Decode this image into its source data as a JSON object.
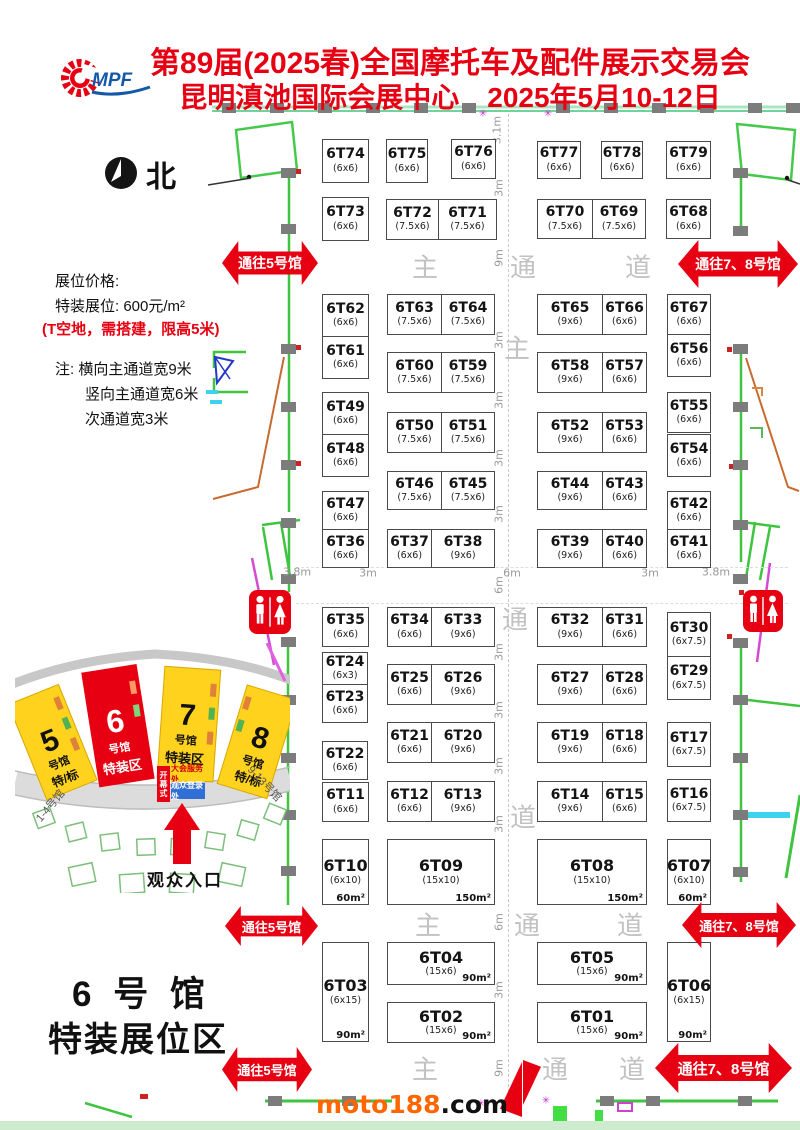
{
  "header": {
    "logo_text": "MPF",
    "title1": "第89届(2025春)全国摩托车及配件展示交易会",
    "title2": "昆明滇池国际会展中心　2025年5月10-12日"
  },
  "north": {
    "label": "北"
  },
  "pricing": {
    "title": "展位价格:",
    "price": "特装展位: 600元/m²",
    "note_red": "(T空地，需搭建，限高5米)",
    "note1": "注: 横向主通道宽9米",
    "note2": "竖向主通道宽6米",
    "note3": "次通道宽3米"
  },
  "arrows": {
    "to5": "通往5号馆",
    "to78": "通往7、8号馆"
  },
  "corridor_glyphs": [
    {
      "t": "主",
      "x": 425,
      "y": 266
    },
    {
      "t": "通",
      "x": 523,
      "y": 266
    },
    {
      "t": "道",
      "x": 638,
      "y": 266
    },
    {
      "t": "主",
      "x": 517,
      "y": 347
    },
    {
      "t": "通",
      "x": 515,
      "y": 618
    },
    {
      "t": "道",
      "x": 523,
      "y": 816
    },
    {
      "t": "主",
      "x": 428,
      "y": 924
    },
    {
      "t": "通",
      "x": 527,
      "y": 924
    },
    {
      "t": "道",
      "x": 630,
      "y": 924
    },
    {
      "t": "主",
      "x": 425,
      "y": 1068
    },
    {
      "t": "通",
      "x": 555,
      "y": 1068
    },
    {
      "t": "道",
      "x": 632,
      "y": 1068
    }
  ],
  "dimensions": [
    {
      "t": "3.1m",
      "x": 497,
      "y": 130,
      "r": 1
    },
    {
      "t": "3m",
      "x": 499,
      "y": 188,
      "r": 1
    },
    {
      "t": "9m",
      "x": 499,
      "y": 258,
      "r": 1
    },
    {
      "t": "3m",
      "x": 499,
      "y": 340,
      "r": 1
    },
    {
      "t": "3m",
      "x": 499,
      "y": 400,
      "r": 1
    },
    {
      "t": "3m",
      "x": 499,
      "y": 458,
      "r": 1
    },
    {
      "t": "3m",
      "x": 499,
      "y": 514,
      "r": 1
    },
    {
      "t": "6m",
      "x": 499,
      "y": 585,
      "r": 1
    },
    {
      "t": "3m",
      "x": 499,
      "y": 652,
      "r": 1
    },
    {
      "t": "3m",
      "x": 499,
      "y": 710,
      "r": 1
    },
    {
      "t": "3m",
      "x": 499,
      "y": 766,
      "r": 1
    },
    {
      "t": "3m",
      "x": 499,
      "y": 824,
      "r": 1
    },
    {
      "t": "6m",
      "x": 499,
      "y": 922,
      "r": 1
    },
    {
      "t": "3m",
      "x": 499,
      "y": 990,
      "r": 1
    },
    {
      "t": "9m",
      "x": 499,
      "y": 1068,
      "r": 1
    },
    {
      "t": "3.8m",
      "x": 297,
      "y": 572,
      "r": 0
    },
    {
      "t": "3m",
      "x": 368,
      "y": 573,
      "r": 0
    },
    {
      "t": "6m",
      "x": 512,
      "y": 573,
      "r": 0
    },
    {
      "t": "3m",
      "x": 650,
      "y": 573,
      "r": 0
    },
    {
      "t": "3.8m",
      "x": 716,
      "y": 572,
      "r": 0
    }
  ],
  "markers": [
    {
      "x": 483,
      "y": 114
    },
    {
      "x": 548,
      "y": 114
    },
    {
      "x": 481,
      "y": 1104
    },
    {
      "x": 546,
      "y": 1101
    }
  ],
  "booths": [
    {
      "id": "6T74",
      "size": "(6x6)",
      "x": 322,
      "y": 139,
      "w": 47,
      "h": 44
    },
    {
      "id": "6T75",
      "size": "(6x6)",
      "x": 386,
      "y": 139,
      "w": 42,
      "h": 44
    },
    {
      "id": "6T76",
      "size": "(6x6)",
      "x": 451,
      "y": 139,
      "w": 45,
      "h": 40
    },
    {
      "id": "6T77",
      "size": "(6x6)",
      "x": 537,
      "y": 141,
      "w": 44,
      "h": 38
    },
    {
      "id": "6T78",
      "size": "(6x6)",
      "x": 601,
      "y": 141,
      "w": 42,
      "h": 38
    },
    {
      "id": "6T79",
      "size": "(6x6)",
      "x": 666,
      "y": 141,
      "w": 45,
      "h": 38
    },
    {
      "id": "6T73",
      "size": "(6x6)",
      "x": 322,
      "y": 197,
      "w": 47,
      "h": 44
    },
    {
      "id": "6T72",
      "size": "(7.5x6)",
      "x": 386,
      "y": 199,
      "w": 53,
      "h": 41
    },
    {
      "id": "6T71",
      "size": "(7.5x6)",
      "x": 438,
      "y": 199,
      "w": 59,
      "h": 41
    },
    {
      "id": "6T70",
      "size": "(7.5x6)",
      "x": 537,
      "y": 199,
      "w": 56,
      "h": 40
    },
    {
      "id": "6T69",
      "size": "(7.5x6)",
      "x": 592,
      "y": 199,
      "w": 54,
      "h": 40
    },
    {
      "id": "6T68",
      "size": "(6x6)",
      "x": 666,
      "y": 199,
      "w": 45,
      "h": 40
    },
    {
      "id": "6T62",
      "size": "(6x6)",
      "x": 322,
      "y": 294,
      "w": 47,
      "h": 43
    },
    {
      "id": "6T61",
      "size": "(6x6)",
      "x": 322,
      "y": 336,
      "w": 47,
      "h": 43
    },
    {
      "id": "6T63",
      "size": "(7.5x6)",
      "x": 387,
      "y": 294,
      "w": 55,
      "h": 41
    },
    {
      "id": "6T64",
      "size": "(7.5x6)",
      "x": 441,
      "y": 294,
      "w": 54,
      "h": 41
    },
    {
      "id": "6T65",
      "size": "(9x6)",
      "x": 537,
      "y": 294,
      "w": 66,
      "h": 41
    },
    {
      "id": "6T66",
      "size": "(6x6)",
      "x": 602,
      "y": 294,
      "w": 45,
      "h": 41
    },
    {
      "id": "6T67",
      "size": "(6x6)",
      "x": 667,
      "y": 294,
      "w": 44,
      "h": 41
    },
    {
      "id": "6T56",
      "size": "(6x6)",
      "x": 667,
      "y": 334,
      "w": 44,
      "h": 43
    },
    {
      "id": "6T60",
      "size": "(7.5x6)",
      "x": 387,
      "y": 352,
      "w": 55,
      "h": 41
    },
    {
      "id": "6T59",
      "size": "(7.5x6)",
      "x": 441,
      "y": 352,
      "w": 54,
      "h": 41
    },
    {
      "id": "6T58",
      "size": "(9x6)",
      "x": 537,
      "y": 352,
      "w": 66,
      "h": 41
    },
    {
      "id": "6T57",
      "size": "(6x6)",
      "x": 602,
      "y": 352,
      "w": 45,
      "h": 41
    },
    {
      "id": "6T49",
      "size": "(6x6)",
      "x": 322,
      "y": 392,
      "w": 47,
      "h": 43
    },
    {
      "id": "6T48",
      "size": "(6x6)",
      "x": 322,
      "y": 434,
      "w": 47,
      "h": 43
    },
    {
      "id": "6T50",
      "size": "(7.5x6)",
      "x": 387,
      "y": 412,
      "w": 55,
      "h": 41
    },
    {
      "id": "6T51",
      "size": "(7.5x6)",
      "x": 441,
      "y": 412,
      "w": 54,
      "h": 41
    },
    {
      "id": "6T52",
      "size": "(9x6)",
      "x": 537,
      "y": 412,
      "w": 66,
      "h": 41
    },
    {
      "id": "6T53",
      "size": "(6x6)",
      "x": 602,
      "y": 412,
      "w": 45,
      "h": 41
    },
    {
      "id": "6T55",
      "size": "(6x6)",
      "x": 667,
      "y": 392,
      "w": 44,
      "h": 41
    },
    {
      "id": "6T54",
      "size": "(6x6)",
      "x": 667,
      "y": 434,
      "w": 44,
      "h": 43
    },
    {
      "id": "6T46",
      "size": "(7.5x6)",
      "x": 387,
      "y": 471,
      "w": 55,
      "h": 39
    },
    {
      "id": "6T45",
      "size": "(7.5x6)",
      "x": 441,
      "y": 471,
      "w": 54,
      "h": 39
    },
    {
      "id": "6T44",
      "size": "(9x6)",
      "x": 537,
      "y": 471,
      "w": 66,
      "h": 39
    },
    {
      "id": "6T43",
      "size": "(6x6)",
      "x": 602,
      "y": 471,
      "w": 45,
      "h": 39
    },
    {
      "id": "6T47",
      "size": "(6x6)",
      "x": 322,
      "y": 491,
      "w": 47,
      "h": 39
    },
    {
      "id": "6T42",
      "size": "(6x6)",
      "x": 667,
      "y": 491,
      "w": 44,
      "h": 39
    },
    {
      "id": "6T36",
      "size": "(6x6)",
      "x": 322,
      "y": 529,
      "w": 47,
      "h": 39
    },
    {
      "id": "6T37",
      "size": "(6x6)",
      "x": 387,
      "y": 529,
      "w": 45,
      "h": 39
    },
    {
      "id": "6T38",
      "size": "(9x6)",
      "x": 431,
      "y": 529,
      "w": 64,
      "h": 39
    },
    {
      "id": "6T39",
      "size": "(9x6)",
      "x": 537,
      "y": 529,
      "w": 66,
      "h": 39
    },
    {
      "id": "6T40",
      "size": "(6x6)",
      "x": 602,
      "y": 529,
      "w": 45,
      "h": 39
    },
    {
      "id": "6T41",
      "size": "(6x6)",
      "x": 667,
      "y": 529,
      "w": 44,
      "h": 39
    },
    {
      "id": "6T35",
      "size": "(6x6)",
      "x": 322,
      "y": 607,
      "w": 47,
      "h": 40
    },
    {
      "id": "6T34",
      "size": "(6x6)",
      "x": 387,
      "y": 607,
      "w": 45,
      "h": 40
    },
    {
      "id": "6T33",
      "size": "(9x6)",
      "x": 431,
      "y": 607,
      "w": 64,
      "h": 40
    },
    {
      "id": "6T32",
      "size": "(9x6)",
      "x": 537,
      "y": 607,
      "w": 66,
      "h": 40
    },
    {
      "id": "6T31",
      "size": "(6x6)",
      "x": 602,
      "y": 607,
      "w": 45,
      "h": 40
    },
    {
      "id": "6T30",
      "size": "(6x7.5)",
      "x": 667,
      "y": 612,
      "w": 44,
      "h": 45
    },
    {
      "id": "6T24",
      "size": "(6x3)",
      "x": 322,
      "y": 652,
      "w": 46,
      "h": 33
    },
    {
      "id": "6T23",
      "size": "(6x6)",
      "x": 322,
      "y": 684,
      "w": 46,
      "h": 39
    },
    {
      "id": "6T25",
      "size": "(6x6)",
      "x": 387,
      "y": 664,
      "w": 45,
      "h": 41
    },
    {
      "id": "6T26",
      "size": "(9x6)",
      "x": 431,
      "y": 664,
      "w": 64,
      "h": 41
    },
    {
      "id": "6T27",
      "size": "(9x6)",
      "x": 537,
      "y": 664,
      "w": 66,
      "h": 41
    },
    {
      "id": "6T28",
      "size": "(6x6)",
      "x": 602,
      "y": 664,
      "w": 45,
      "h": 41
    },
    {
      "id": "6T29",
      "size": "(6x7.5)",
      "x": 667,
      "y": 656,
      "w": 44,
      "h": 44
    },
    {
      "id": "6T22",
      "size": "(6x6)",
      "x": 322,
      "y": 741,
      "w": 46,
      "h": 39
    },
    {
      "id": "6T21",
      "size": "(6x6)",
      "x": 387,
      "y": 722,
      "w": 45,
      "h": 41
    },
    {
      "id": "6T20",
      "size": "(9x6)",
      "x": 431,
      "y": 722,
      "w": 64,
      "h": 41
    },
    {
      "id": "6T19",
      "size": "(9x6)",
      "x": 537,
      "y": 722,
      "w": 66,
      "h": 41
    },
    {
      "id": "6T18",
      "size": "(6x6)",
      "x": 602,
      "y": 722,
      "w": 45,
      "h": 41
    },
    {
      "id": "6T17",
      "size": "(6x7.5)",
      "x": 667,
      "y": 722,
      "w": 44,
      "h": 45
    },
    {
      "id": "6T11",
      "size": "(6x6)",
      "x": 322,
      "y": 782,
      "w": 47,
      "h": 40
    },
    {
      "id": "6T12",
      "size": "(6x6)",
      "x": 387,
      "y": 781,
      "w": 45,
      "h": 41
    },
    {
      "id": "6T13",
      "size": "(9x6)",
      "x": 431,
      "y": 781,
      "w": 64,
      "h": 41
    },
    {
      "id": "6T14",
      "size": "(9x6)",
      "x": 537,
      "y": 781,
      "w": 66,
      "h": 41
    },
    {
      "id": "6T15",
      "size": "(6x6)",
      "x": 602,
      "y": 781,
      "w": 45,
      "h": 41
    },
    {
      "id": "6T16",
      "size": "(6x7.5)",
      "x": 667,
      "y": 779,
      "w": 44,
      "h": 43
    },
    {
      "id": "6T10",
      "size": "(6x10)",
      "area": "60m²",
      "x": 322,
      "y": 839,
      "w": 47,
      "h": 66
    },
    {
      "id": "6T09",
      "size": "(15x10)",
      "area": "150m²",
      "x": 387,
      "y": 839,
      "w": 108,
      "h": 66
    },
    {
      "id": "6T08",
      "size": "(15x10)",
      "area": "150m²",
      "x": 537,
      "y": 839,
      "w": 110,
      "h": 66
    },
    {
      "id": "6T07",
      "size": "(6x10)",
      "area": "60m²",
      "x": 667,
      "y": 839,
      "w": 44,
      "h": 66
    },
    {
      "id": "6T03",
      "size": "(6x15)",
      "area": "90m²",
      "x": 322,
      "y": 942,
      "w": 47,
      "h": 100
    },
    {
      "id": "6T04",
      "size": "(15x6)",
      "area": "90m²",
      "x": 387,
      "y": 942,
      "w": 108,
      "h": 43
    },
    {
      "id": "6T05",
      "size": "(15x6)",
      "area": "90m²",
      "x": 537,
      "y": 942,
      "w": 110,
      "h": 43
    },
    {
      "id": "6T06",
      "size": "(6x15)",
      "area": "90m²",
      "x": 667,
      "y": 942,
      "w": 44,
      "h": 100
    },
    {
      "id": "6T02",
      "size": "(15x6)",
      "area": "90m²",
      "x": 387,
      "y": 1002,
      "w": 108,
      "h": 41
    },
    {
      "id": "6T01",
      "size": "(15x6)",
      "area": "90m²",
      "x": 537,
      "y": 1002,
      "w": 110,
      "h": 41
    }
  ],
  "inset": {
    "halls": [
      {
        "num": "5",
        "sub": "号馆",
        "tag": "特/标"
      },
      {
        "num": "6",
        "sub": "号馆",
        "tag": "特装区"
      },
      {
        "num": "7",
        "sub": "号馆",
        "tag": "特装区"
      },
      {
        "num": "8",
        "sub": "号馆",
        "tag": "特/标"
      }
    ],
    "left_label": "1-4号馆",
    "right_label": "9-13号馆",
    "opening": "开幕式",
    "service": "大会服务处",
    "register": "观众登录处",
    "entrance": "观众入口"
  },
  "footer": {
    "hall1": "6 号 馆",
    "hall2": "特装展位区",
    "wm1": "moto188",
    "wm2": ".com"
  }
}
